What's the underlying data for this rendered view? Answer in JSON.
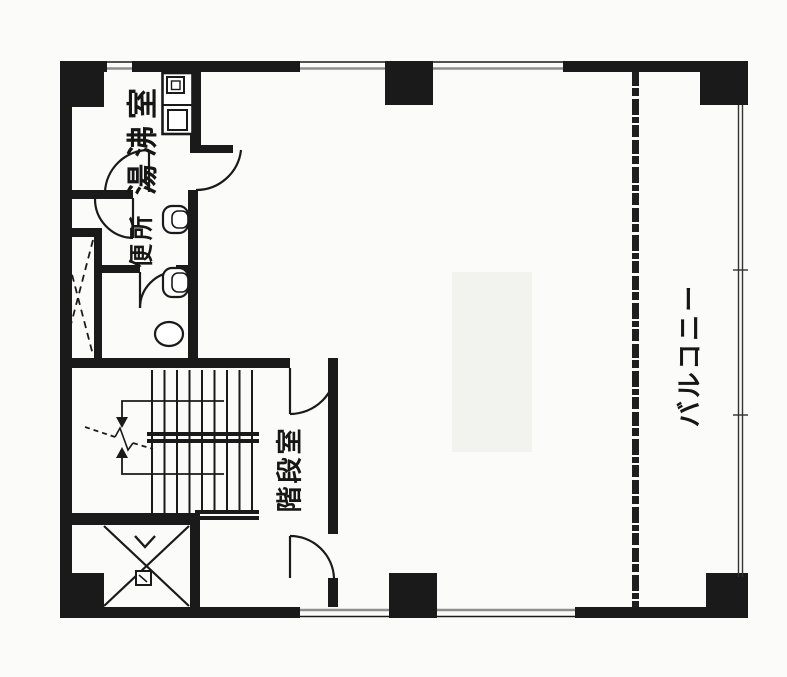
{
  "floor_plan": {
    "rooms": {
      "kitchenette": {
        "label": "湯沸室"
      },
      "toilet": {
        "label": "便所"
      },
      "stairwell": {
        "label": "階段室"
      },
      "balcony": {
        "label": "バルコニー"
      }
    },
    "colors": {
      "ink": "#1a1a1a",
      "paper": "#fbfbf9",
      "window_line": "#8e8e8e"
    }
  }
}
